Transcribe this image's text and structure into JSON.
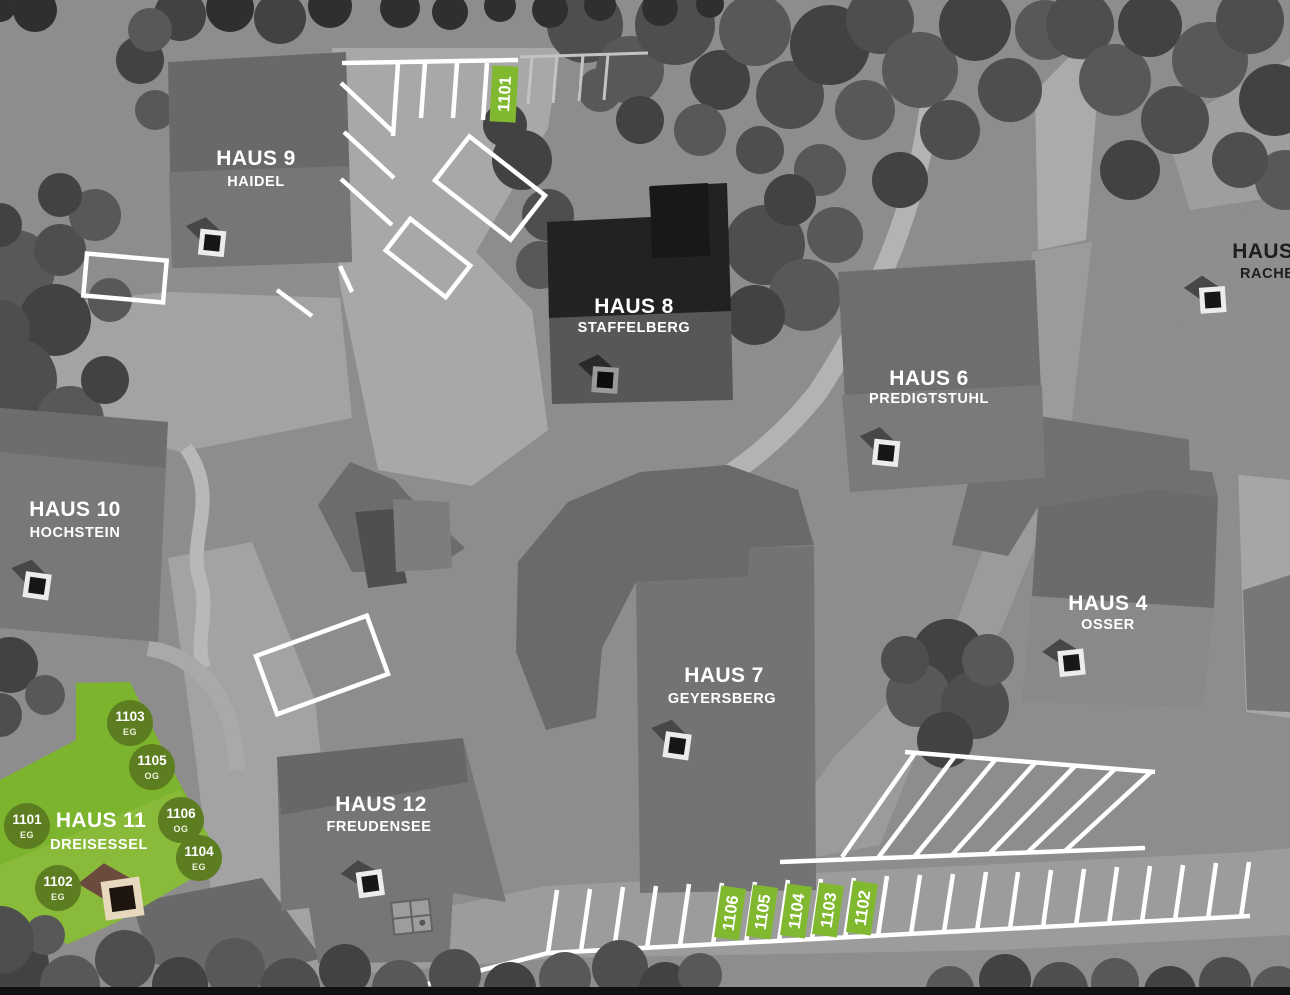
{
  "buildings": [
    {
      "name": "HAUS 9",
      "subtitle": "HAIDEL"
    },
    {
      "name": "HAUS 8",
      "subtitle": "STAFFELBERG"
    },
    {
      "name": "HAUS 6",
      "subtitle": "PREDIGTSTUHL"
    },
    {
      "name": "HAUS 5",
      "subtitle": "RACHEL"
    },
    {
      "name": "HAUS 10",
      "subtitle": "HOCHSTEIN"
    },
    {
      "name": "HAUS 7",
      "subtitle": "GEYERSBERG"
    },
    {
      "name": "HAUS 4",
      "subtitle": "OSSER"
    },
    {
      "name": "HAUS 11",
      "subtitle": "DREISESSEL"
    },
    {
      "name": "HAUS 12",
      "subtitle": "FREUDENSEE"
    }
  ],
  "haus11_units": [
    {
      "number": "1103",
      "floor": "EG"
    },
    {
      "number": "1105",
      "floor": "OG"
    },
    {
      "number": "1106",
      "floor": "OG"
    },
    {
      "number": "1104",
      "floor": "EG"
    },
    {
      "number": "1101",
      "floor": "EG"
    },
    {
      "number": "1102",
      "floor": "EG"
    }
  ],
  "parking": {
    "top_spot": "1101",
    "bottom_spots": [
      "1106",
      "1105",
      "1104",
      "1103",
      "1102"
    ]
  },
  "colors": {
    "highlight_green": "#7cb42e",
    "highlight_green_light": "#8aba3a",
    "badge_green": "#5d7e20",
    "spot_green": "#80b92f",
    "entrance_brown": "#6a4b3e",
    "entrance_brown_frame": "#e7d9bd"
  }
}
